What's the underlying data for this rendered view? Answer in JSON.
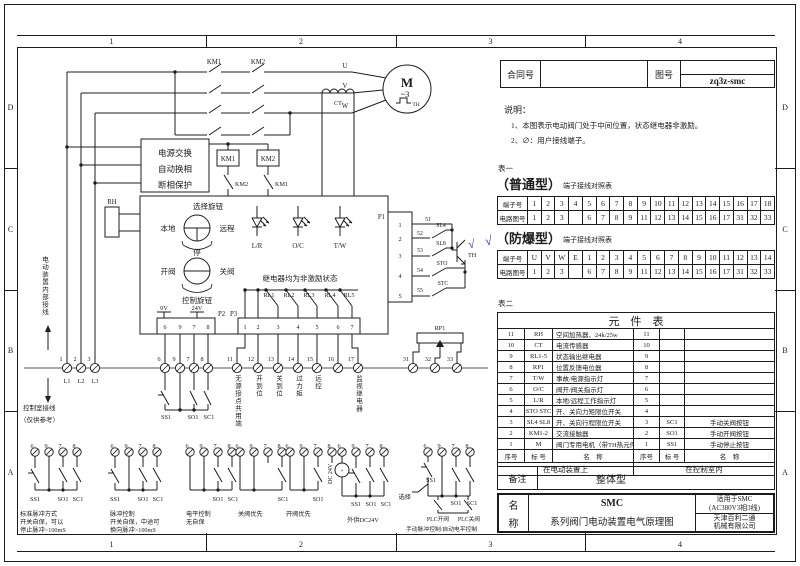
{
  "zones": {
    "cols": [
      "1",
      "2",
      "3",
      "4"
    ],
    "rows": [
      "D",
      "C",
      "B",
      "A"
    ]
  },
  "title_block": {
    "contract_label": "合同号",
    "contract_value": "",
    "drawing_label": "图号",
    "drawing_value": "zq3z-smc"
  },
  "notes": {
    "heading": "说明：",
    "item1": "1、本图表示电动阀门处于中间位置，状态继电器非激励。",
    "item2": "2、∅：用户接线端子。"
  },
  "table1": {
    "caption": "表一",
    "type": "（普通型）",
    "subtitle": "端子接线对照表",
    "row1_label": "端子号",
    "row2_label": "电路图号",
    "row1": [
      "1",
      "2",
      "3",
      "4",
      "5",
      "6",
      "7",
      "8",
      "9",
      "10",
      "11",
      "12",
      "13",
      "14",
      "15",
      "16",
      "17",
      "18"
    ],
    "row2": [
      "1",
      "2",
      "3",
      "",
      "6",
      "7",
      "8",
      "9",
      "11",
      "12",
      "13",
      "14",
      "15",
      "16",
      "17",
      "31",
      "32",
      "33"
    ]
  },
  "table2": {
    "check": "√",
    "type": "（防爆型）",
    "subtitle": "端子接线对照表",
    "row1_label": "端子号",
    "row2_label": "电路图号",
    "row1": [
      "U",
      "V",
      "W",
      "E",
      "1",
      "2",
      "3",
      "4",
      "5",
      "6",
      "7",
      "8",
      "9",
      "10",
      "11",
      "12",
      "13",
      "14"
    ],
    "row2": [
      "1",
      "2",
      "3",
      "",
      "6",
      "7",
      "8",
      "9",
      "11",
      "12",
      "13",
      "14",
      "15",
      "16",
      "17",
      "31",
      "32",
      "33"
    ]
  },
  "component_table": {
    "caption": "表二",
    "title": "元　件　表",
    "rows": [
      {
        "no": "11",
        "tag": "RH",
        "name": "空间加热器、24k/25w",
        "no2": "11",
        "tag2": "",
        "name2": ""
      },
      {
        "no": "10",
        "tag": "CT",
        "name": "电流传感器",
        "no2": "10",
        "tag2": "",
        "name2": ""
      },
      {
        "no": "9",
        "tag": "RL1-5",
        "name": "状态输出继电器",
        "no2": "9",
        "tag2": "",
        "name2": ""
      },
      {
        "no": "8",
        "tag": "RP1",
        "name": "位置反馈电位器",
        "no2": "8",
        "tag2": "",
        "name2": ""
      },
      {
        "no": "7",
        "tag": "T/W",
        "name": "事故/电源指示灯",
        "no2": "7",
        "tag2": "",
        "name2": ""
      },
      {
        "no": "6",
        "tag": "O/C",
        "name": "阀开/阀关指示灯",
        "no2": "6",
        "tag2": "",
        "name2": ""
      },
      {
        "no": "5",
        "tag": "L/R",
        "name": "本地/远程工作指示灯",
        "no2": "5",
        "tag2": "",
        "name2": ""
      },
      {
        "no": "4",
        "tag": "STO STC",
        "name": "开、关向力矩限位开关",
        "no2": "4",
        "tag2": "",
        "name2": ""
      },
      {
        "no": "3",
        "tag": "SL4 SL8",
        "name": "开、关向行程限位开关",
        "no2": "3",
        "tag2": "SC1",
        "name2": "手动关阀按钮"
      },
      {
        "no": "2",
        "tag": "KM1-2",
        "name": "交流接触器",
        "no2": "2",
        "tag2": "SO1",
        "name2": "手动开阀按钮"
      },
      {
        "no": "1",
        "tag": "M",
        "name": "阀门专用电机（带TH热元件）",
        "no2": "1",
        "tag2": "SS1",
        "name2": "手动停止按钮"
      }
    ],
    "header": {
      "no": "序号",
      "tag": "标 号",
      "name": "名　称",
      "no2": "序号",
      "tag2": "标 号",
      "name2": "名　称"
    },
    "footer_left": "在电动装置上",
    "footer_right": "在控制室内"
  },
  "remark": {
    "label": "备注",
    "value": "整体型"
  },
  "name_block": {
    "label_1": "名",
    "label_2": "称",
    "line1": "SMC",
    "line2": "系列阀门电动装置电气原理图",
    "right_top1": "适用于SMC",
    "right_top2": "(AC380V3相3线)",
    "right_bot1": "天津百利二通",
    "right_bot2": "机械有限公司"
  },
  "sch": {
    "km1": "KM1",
    "km2": "KM2",
    "u": "U",
    "v": "V",
    "w": "W",
    "m": "M",
    "ph3": "~3",
    "th": "TH",
    "ct": "CT",
    "psu1": "电源交换",
    "psu2": "自动换相",
    "psu3": "断相保护",
    "km1c": "KM1",
    "km2c": "KM2",
    "km2b": "KM2",
    "km1b": "KM1",
    "rh": "RH",
    "sel_knob": "选择旋钮",
    "local": "本地",
    "remote": "远程",
    "stop": "停",
    "open": "开阀",
    "close": "关阀",
    "ctrl_knob": "控制旋钮",
    "lr": "L/R",
    "oc": "O/C",
    "tw": "T/W",
    "relay_note": "继电器均为非激励状态",
    "rl1": "RL1",
    "rl2": "RL2",
    "rl3": "RL3",
    "rl4": "RL4",
    "rl5": "RL5",
    "v0": "0V",
    "v24": "24V",
    "p1": "P1",
    "p2": "P2",
    "p3": "P3",
    "p2p": [
      "6",
      "9",
      "7",
      "8"
    ],
    "p3p": [
      "1",
      "2",
      "3",
      "4",
      "5",
      "6",
      "7"
    ],
    "p1p": [
      "1",
      "2",
      "3",
      "4",
      "5"
    ],
    "w51": "51",
    "w52": "52",
    "w53": "53",
    "w54": "54",
    "w55": "55",
    "sl4": "SL4",
    "sl8": "SL8",
    "sto": "STO",
    "stc": "STC",
    "th2": "TH",
    "rp1": "RP1",
    "check": "√",
    "t1": "1",
    "t2": "2",
    "t3": "3",
    "t6": "6",
    "t9": "9",
    "t7": "7",
    "t8": "8",
    "t11": "11",
    "t12": "12",
    "t13": "13",
    "t14": "14",
    "t15": "15",
    "t16": "16",
    "t17": "17",
    "t31": "31",
    "t32": "32",
    "t33": "33",
    "l1": "L1",
    "l2": "L2",
    "l3": "L3",
    "ss1": "SS1",
    "so1": "SO1",
    "sc1": "SC1",
    "gnum": [
      "6",
      "9",
      "7",
      "8"
    ],
    "v11": "无源接点共用端",
    "v12": "开到位",
    "v13": "关到位",
    "v14": "过力矩",
    "v15": "远控",
    "v17": "监视继电器",
    "inner": "电动装置内部接线",
    "room": "控制室接线",
    "ref": "（仅供参考）",
    "dc24": "DC 24V",
    "plus": "+",
    "sel2": "选择",
    "plco": "PLC开阀",
    "plcc": "PLC关阀",
    "g1a": "标准脉冲方式",
    "g1b": "开关自保，可以",
    "g1c": "停止脉冲>100mS",
    "g2a": "脉冲控制",
    "g2b": "开关自保，中途可",
    "g2c": "换向脉冲>100mS",
    "g3a": "电平控制",
    "g3b": "无自保",
    "g4": "关阀优先",
    "g5": "开阀优先",
    "g6": "外供DC24V",
    "g7": "手动脉冲控制/自动电平控制"
  }
}
